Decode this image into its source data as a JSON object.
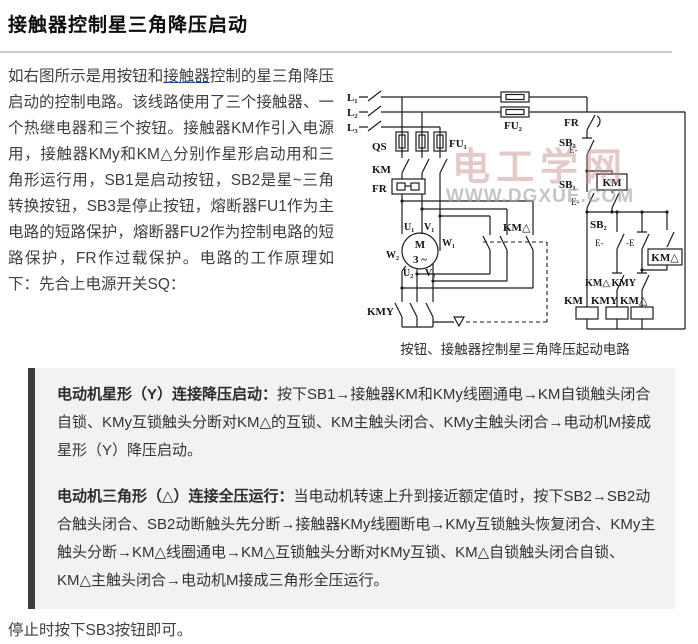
{
  "title": "接触器控制星三角降压启动",
  "intro": {
    "before_link": "如右图所示是用按钮和",
    "link_text": "接触器",
    "after_link": "控制的星三角降压启动的控制电路。该线路使用了三个接触器、一个热继电器和三个按钮。接触器KM作引入电源用，接触器KMy和KM△分别作星形启动用和三角形运行用，SB1是启动按钮，SB2是星~三角转换按钮，SB3是停止按钮，熔断器FU1作为主电路的短路保护，熔断器FU2作为控制电路的短路保护，FR作过载保护。电路的工作原理如下：先合上电源开关SQ："
  },
  "diagram": {
    "caption": "按钮、接触器控制星三角降压起动电路",
    "watermark_line1": "电工学网",
    "watermark_line2": "WWW.DGXUE.COM",
    "labels": {
      "l1": "L₁",
      "l2": "L₂",
      "l3": "L₃",
      "qs": "QS",
      "fu1": "FU₁",
      "fu2": "FU₂",
      "km_main": "KM",
      "fr_main": "FR",
      "u1": "U₁",
      "v1": "V₁",
      "w1": "W₁",
      "w2": "W₂",
      "u2": "U₂",
      "v2": "V₂",
      "motor_m": "M",
      "motor_ph": "3 ~",
      "kmy_main": "KMY",
      "kmd_main": "KM△",
      "fr_ctrl": "FR",
      "sb3": "SB₃",
      "sb1": "SB₁",
      "sb2": "SB₂",
      "e_sb3": "E-",
      "e_sb1": "E-",
      "e_sb2a": "E-",
      "e_sb2b": "-E",
      "km_aux": "KM",
      "kmd_aux": "KM△",
      "il_kmd": "KM△",
      "il_kmy": "KMY",
      "coil_km": "KM",
      "coil_kmy": "KMY",
      "coil_kmd": "KM△"
    }
  },
  "notes": {
    "para1_lead": "电动机星形（Y）连接降压启动：",
    "para1_body": "按下SB1→接触器KM和KMy线圈通电→KM自锁触头闭合自锁、KMy互锁触头分断对KM△的互锁、KM主触头闭合、KMy主触头闭合→电动机M接成星形（Y）降压启动。",
    "para2_lead": "电动机三角形（△）连接全压运行：",
    "para2_body": "当电动机转速上升到接近额定值时，按下SB2→SB2动合触头闭合、SB2动断触头先分断→接触器KMy线圈断电→KMy互锁触头恢复闭合、KMy主触头分断→KM△线圈通电→KM△互锁触头分断对KMy互锁、KM△自锁触头闭合自锁、KM△主触头闭合→电动机M接成三角形全压运行。"
  },
  "footer": {
    "text": "停止时按下SB3按钮即可。"
  },
  "colors": {
    "link_underline": "#2244cc",
    "quote_background": "#f2f2f2",
    "quote_border": "#3a3a3a",
    "watermark_pink": "#c98f8f",
    "watermark_gray": "#9f9f9f",
    "divider_gray": "#c9c9c9"
  }
}
